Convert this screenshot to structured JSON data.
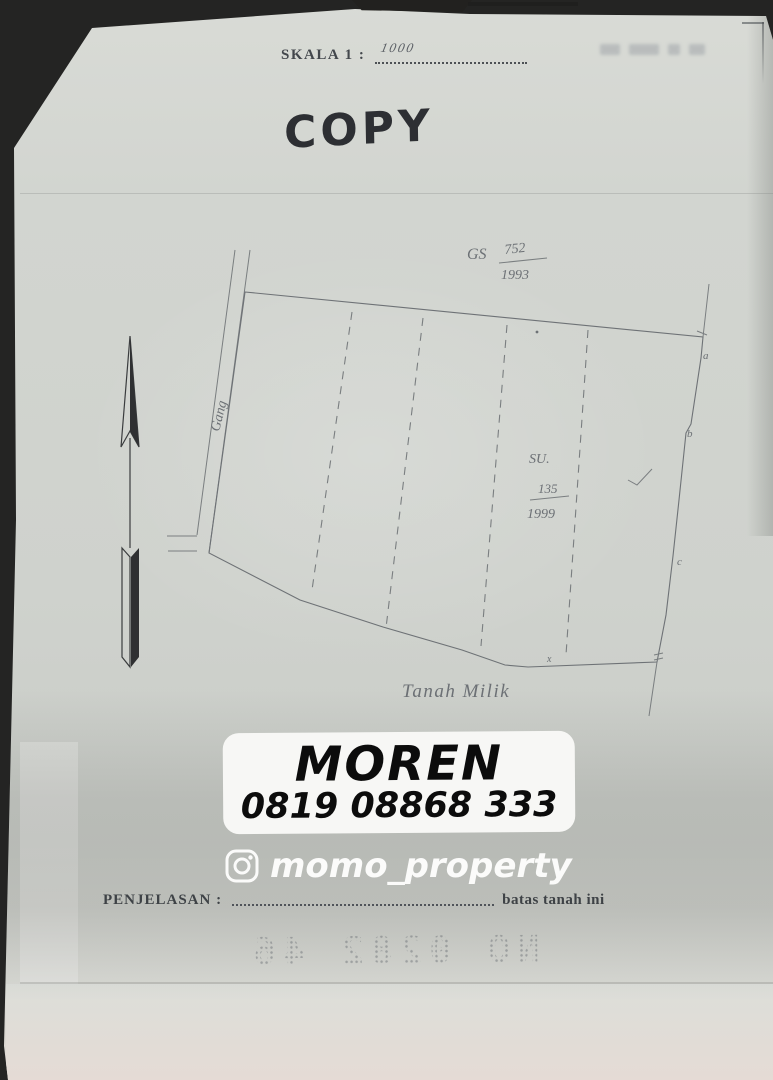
{
  "header": {
    "scale_label": "SKALA 1 :",
    "scale_value": "1000",
    "copy_stamp": "COPY"
  },
  "map": {
    "gs_label": "GS",
    "gs_numerator": "752",
    "gs_denominator": "1993",
    "su_label": "SU.",
    "su_numerator": "135",
    "su_denominator": "1999",
    "road_label": "Gang",
    "land_label": "Tanah Milik",
    "boundary_letters": [
      "a",
      "b",
      "c"
    ],
    "junction_mark": "x"
  },
  "watermark": {
    "brand": "MOREN",
    "phone": "0819 08868 333",
    "instagram_handle": "momo_property",
    "box_color": "#f7f7f5",
    "text_color": "#0c0c0c",
    "handle_color": "#fbfbfa"
  },
  "footer": {
    "label": "PENJELASAN :",
    "suffix": "batas tanah ini",
    "perforated_number": "NO 0282 46"
  },
  "colors": {
    "background": "#242423",
    "paper": "#d2d5d0",
    "ink": "#6e7276",
    "printed_text": "#43474c"
  }
}
